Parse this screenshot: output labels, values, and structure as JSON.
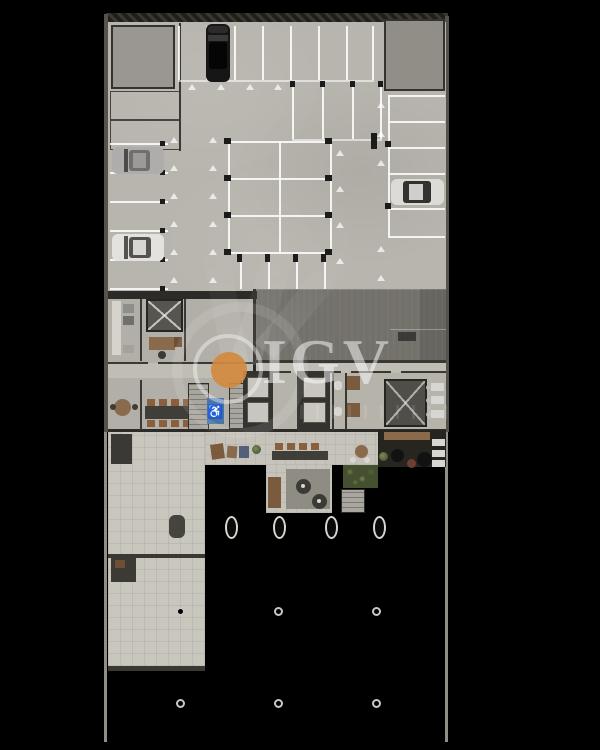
{
  "meta": {
    "description": "Top-down 3D architectural floor plan rendering of a building ground floor with parking garage, lobby and terrace on a black background",
    "view": "top-down"
  },
  "canvas": {
    "width": 600,
    "height": 750,
    "background": "#000000"
  },
  "watermark": {
    "text": "IGV",
    "logo_icon": "circle-dot-logo-icon",
    "accent_color": "#D18A3F",
    "text_color": "rgba(255,255,255,0.5)"
  },
  "icons": {
    "handicap": "♿"
  },
  "palette": {
    "garage_floor": "#b8b5ae",
    "slab_dark": "#73716a",
    "tile_floor": "#c9c6be",
    "wall_dark": "#2c2b27",
    "marking_white": "rgba(255,255,255,0.85)",
    "handicap_blue": "#4a74a8",
    "wood": "#8a6a4d",
    "plant_green": "#5d6b42"
  },
  "objects": {
    "cars": [
      {
        "name": "black-suv",
        "area": "top-entry-spot",
        "orientation": "vertical"
      },
      {
        "name": "silver-car",
        "area": "left-spot-row",
        "orientation": "horizontal"
      },
      {
        "name": "white-car",
        "area": "left-spot-row",
        "orientation": "horizontal"
      },
      {
        "name": "white-car",
        "area": "right-spot-row",
        "orientation": "horizontal"
      }
    ],
    "parking": {
      "top_spots": 7,
      "left_spot_rows": 5,
      "right_spot_rows": 5,
      "center_grid_rows": 3,
      "center_grid_cols": 2,
      "accessible_spots": 1
    },
    "vertical_circulation": {
      "elevator_banks": 2,
      "stair_flights": 3,
      "x_marked_shafts": 2
    },
    "oval_pillars": 4,
    "round_columns": 6
  }
}
